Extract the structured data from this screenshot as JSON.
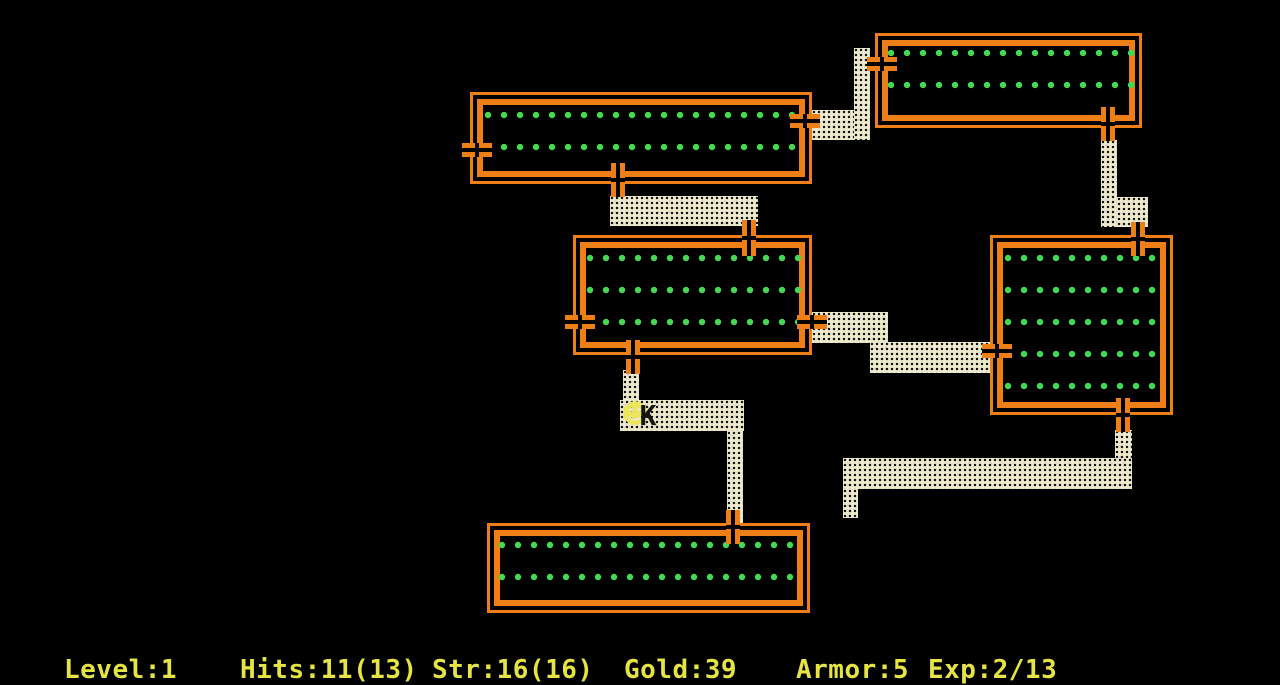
{
  "game": "Rogue dungeon level",
  "status_bar": {
    "level": "Level:1",
    "hits": "Hits:11(13)",
    "strength": "Str:16(16)",
    "gold": "Gold:39",
    "armor": "Armor:5",
    "experience": "Exp:2/13"
  },
  "entities": {
    "player_symbol": "☻",
    "monster_symbol": "K"
  },
  "map": {
    "rooms": [
      "room-top",
      "room-top-right",
      "room-center",
      "room-east",
      "room-south"
    ],
    "corridor_segments": 13,
    "doors": 12
  },
  "colors": {
    "background": "#000000",
    "wall_orange": "#ee7f16",
    "floor_dot_green": "#3fdc4f",
    "corridor_beige": "#ece9cd",
    "status_yellow": "#e6e440",
    "player_yellow": "#ede65c",
    "monster_black": "#141410"
  }
}
